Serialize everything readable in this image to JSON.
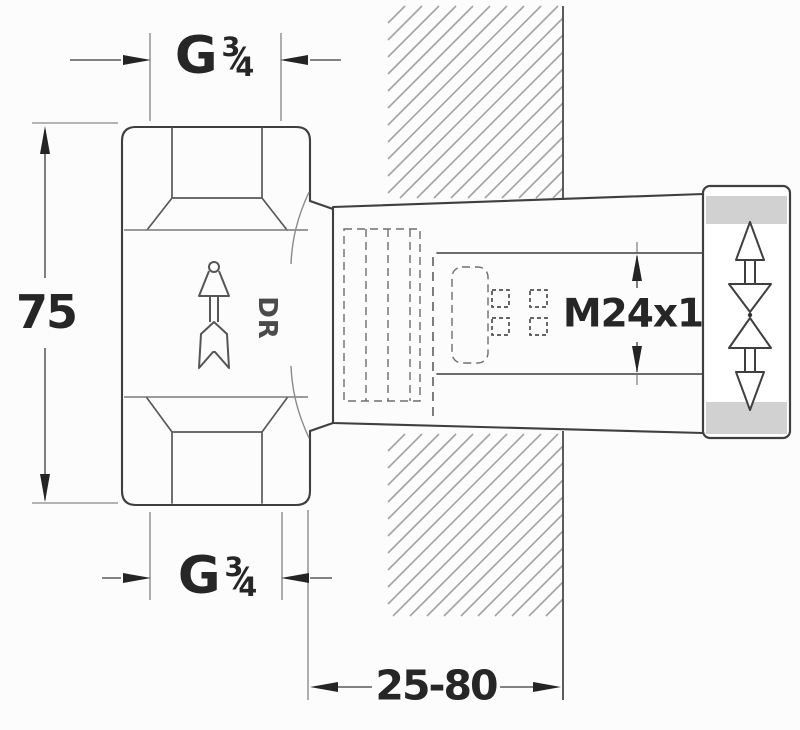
{
  "labels": {
    "top_thread": {
      "prefix": "G",
      "numerator": "3",
      "slash": "⁄",
      "denominator": "4"
    },
    "bottom_thread": {
      "prefix": "G",
      "numerator": "3",
      "slash": "⁄",
      "denominator": "4"
    },
    "body_height": "75",
    "spindle_thread": "M24x1",
    "mounting_depth_range": "25-80",
    "body_stamp": "DR"
  },
  "colors": {
    "line": "#3f3f3f",
    "hatch": "#a3a3a3",
    "cap_band": "#c6c6c6",
    "text": "#262626",
    "background": "#fcfcfc"
  }
}
